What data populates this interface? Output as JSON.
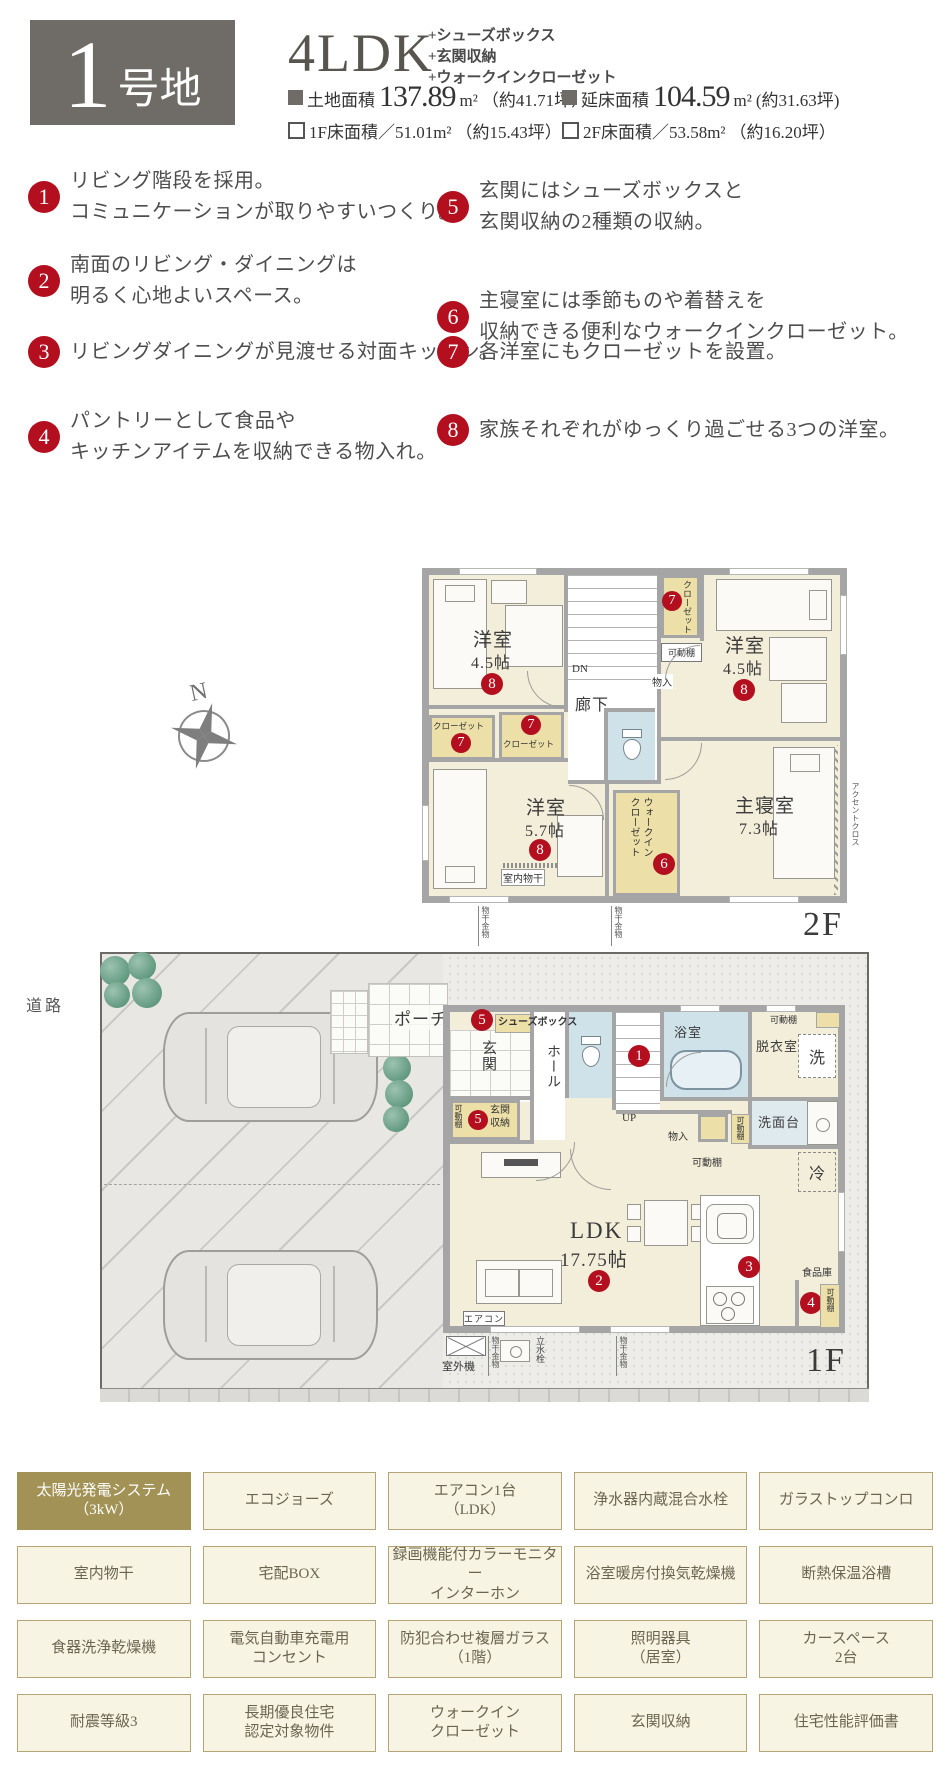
{
  "header": {
    "lot_number": "1",
    "lot_suffix": "号地",
    "plan_type": "4LDK",
    "plan_extras": [
      "+シューズボックス",
      "+玄関収納",
      "+ウォークインクローゼット"
    ],
    "area": {
      "a1_label": "土地面積",
      "a1_value": "137.89",
      "a1_unit": "m²",
      "a1_tsubo": "（約41.71坪）",
      "a2_label": "延床面積",
      "a2_value": "104.59",
      "a2_unit": "m²",
      "a2_tsubo": "(約31.63坪)",
      "a3_text": "1F床面積／51.01m²",
      "a3_tsubo": "（約15.43坪）",
      "a4_text": "2F床面積／53.58m²",
      "a4_tsubo": "（約16.20坪）"
    }
  },
  "features": [
    {
      "num": "1",
      "lines": [
        "リビング階段を採用。",
        "コミュニケーションが取りやすいつくり。"
      ]
    },
    {
      "num": "2",
      "lines": [
        "南面のリビング・ダイニングは",
        "明るく心地よいスペース。"
      ]
    },
    {
      "num": "3",
      "lines": [
        "リビングダイニングが見渡せる対面キッチン。"
      ]
    },
    {
      "num": "4",
      "lines": [
        "パントリーとして食品や",
        "キッチンアイテムを収納できる物入れ。"
      ]
    },
    {
      "num": "5",
      "lines": [
        "玄関にはシューズボックスと",
        "玄関収納の2種類の収納。"
      ]
    },
    {
      "num": "6",
      "lines": [
        "主寝室には季節ものや着替えを",
        "収納できる便利なウォークインクローゼット。"
      ]
    },
    {
      "num": "7",
      "lines": [
        "各洋室にもクローゼットを設置。"
      ]
    },
    {
      "num": "8",
      "lines": [
        "家族それぞれがゆっくり過ごせる3つの洋室。"
      ]
    }
  ],
  "badges": {
    "n1": "1",
    "n2": "2",
    "n3": "3",
    "n4": "4",
    "n5": "5",
    "n6": "6",
    "n7": "7",
    "n8": "8"
  },
  "compass": {
    "n": "N"
  },
  "plan2f": {
    "floor_label": "2F",
    "rooms": {
      "yoshitsu": "洋室",
      "size45": "4.5帖",
      "size57": "5.7帖",
      "master": "主寝室",
      "size73": "7.3帖",
      "hallway": "廊下",
      "dn": "DN",
      "closet": "クローゼット",
      "wic": "ウォークイン\nクローゼット",
      "kadoudana": "可動棚",
      "monoire": "物入",
      "indoor_drying": "室内物干",
      "drying_hardware": "物干金物",
      "accent_cross": "アクセントクロス"
    }
  },
  "plan1f": {
    "floor_label": "1F",
    "road": "道路",
    "rooms": {
      "porch": "ポーチ",
      "shoes_box": "シューズボックス",
      "genkan": "玄関",
      "hall": "ホール",
      "genkan_storage": "玄関収納",
      "kadoudana": "可動棚",
      "up": "UP",
      "bath": "浴室",
      "dressing": "脱衣室",
      "washer": "洗",
      "vanity": "洗面台",
      "monoire": "物入",
      "fridge": "冷",
      "ldk": "LDK",
      "ldk_size": "17.75帖",
      "aircon": "エアコン",
      "outdoor_unit": "室外機",
      "faucet": "立水栓",
      "drying_hardware": "物干金物",
      "pantry": "食品庫"
    }
  },
  "tags": {
    "items": [
      {
        "label": "太陽光発電システム\n（3kW）",
        "highlight": true
      },
      {
        "label": "エコジョーズ",
        "highlight": false
      },
      {
        "label": "エアコン1台\n（LDK）",
        "highlight": false
      },
      {
        "label": "浄水器内蔵混合水栓",
        "highlight": false
      },
      {
        "label": "ガラストップコンロ",
        "highlight": false
      },
      {
        "label": "室内物干",
        "highlight": false
      },
      {
        "label": "宅配BOX",
        "highlight": false
      },
      {
        "label": "録画機能付カラーモニター\nインターホン",
        "highlight": false
      },
      {
        "label": "浴室暖房付換気乾燥機",
        "highlight": false
      },
      {
        "label": "断熱保温浴槽",
        "highlight": false
      },
      {
        "label": "食器洗浄乾燥機",
        "highlight": false
      },
      {
        "label": "電気自動車充電用\nコンセント",
        "highlight": false
      },
      {
        "label": "防犯合わせ複層ガラス\n（1階）",
        "highlight": false
      },
      {
        "label": "照明器具\n（居室）",
        "highlight": false
      },
      {
        "label": "カースペース\n2台",
        "highlight": false
      },
      {
        "label": "耐震等級3",
        "highlight": false
      },
      {
        "label": "長期優良住宅\n認定対象物件",
        "highlight": false
      },
      {
        "label": "ウォークイン\nクローゼット",
        "highlight": false
      },
      {
        "label": "玄関収納",
        "highlight": false
      },
      {
        "label": "住宅性能評価書",
        "highlight": false
      }
    ]
  },
  "colors": {
    "badge_red": "#b30f1e",
    "header_box": "#6f6b66",
    "tag_highlight": "#a29255",
    "room_cream": "#f3eeda",
    "closet_yellow": "#ece0a8",
    "bath_blue": "#cfe2ea",
    "wall_gray": "#a5a5a5"
  }
}
